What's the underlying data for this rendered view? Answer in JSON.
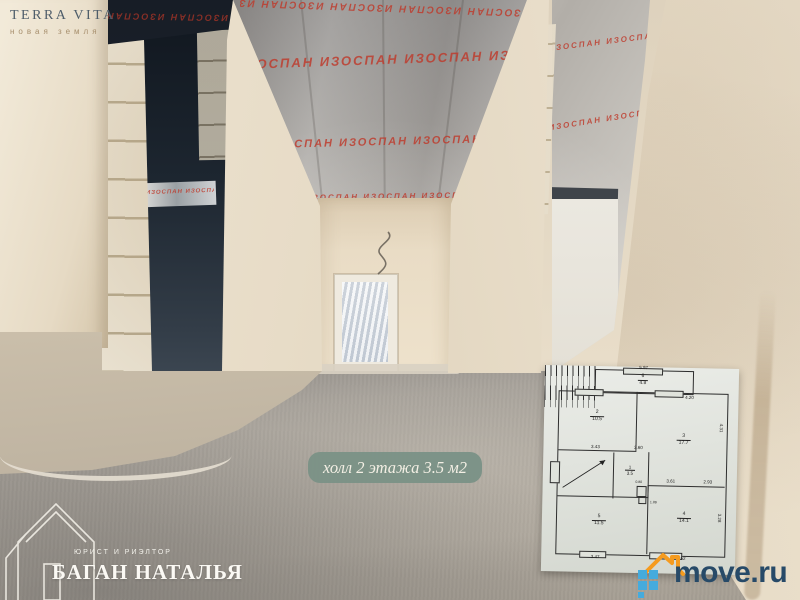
{
  "watermarks": {
    "terra_vita": {
      "title": "TERRA VITA",
      "subtitle": "новая земля"
    },
    "realtor": {
      "role": "ЮРИСТ И РИЭЛТОР",
      "name": "БАГАН НАТАЛЬЯ"
    },
    "move_ru": {
      "text": "move.ru"
    }
  },
  "caption": {
    "text": "холл 2 этажа 3.5 м2"
  },
  "photo": {
    "insulation_brand": "ИЗОСПАН",
    "insulation_row": "ИЗОСПАН      ИЗОСПАН      ИЗОСПАН      ИЗОСПАН      ИЗОСПАН      ИЗОСПАН"
  },
  "floor_plan": {
    "rooms": [
      {
        "num": "6",
        "area": "4.8"
      },
      {
        "num": "2",
        "area": "10.5"
      },
      {
        "num": "3",
        "area": "17.7"
      },
      {
        "num": "1",
        "area": "3.5"
      },
      {
        "num": "5",
        "area": "11.5"
      },
      {
        "num": "4",
        "area": "14.1"
      }
    ],
    "dims": {
      "top": "5.97",
      "room3_top": "4.20",
      "room2_bottom": "3.43",
      "hall_bottom": "3.60",
      "room4_top_left": "3.61",
      "room4_top_right": "2.93",
      "room5_bottom": "3.47",
      "room4_bottom": "4.52",
      "right_upper": "4.31",
      "right_lower": "3.28",
      "wc_width": "0.80",
      "wc_depth": "1.89"
    }
  },
  "colors": {
    "caption_bg": "#7b9286",
    "move_blue": "#274a68",
    "move_orange": "#f59b1f",
    "move_squares": "#45abdd",
    "terra_title": "#4e5d6a",
    "terra_subtitle": "#a78f6d",
    "foil_brand_text": "#bf3a2b"
  }
}
